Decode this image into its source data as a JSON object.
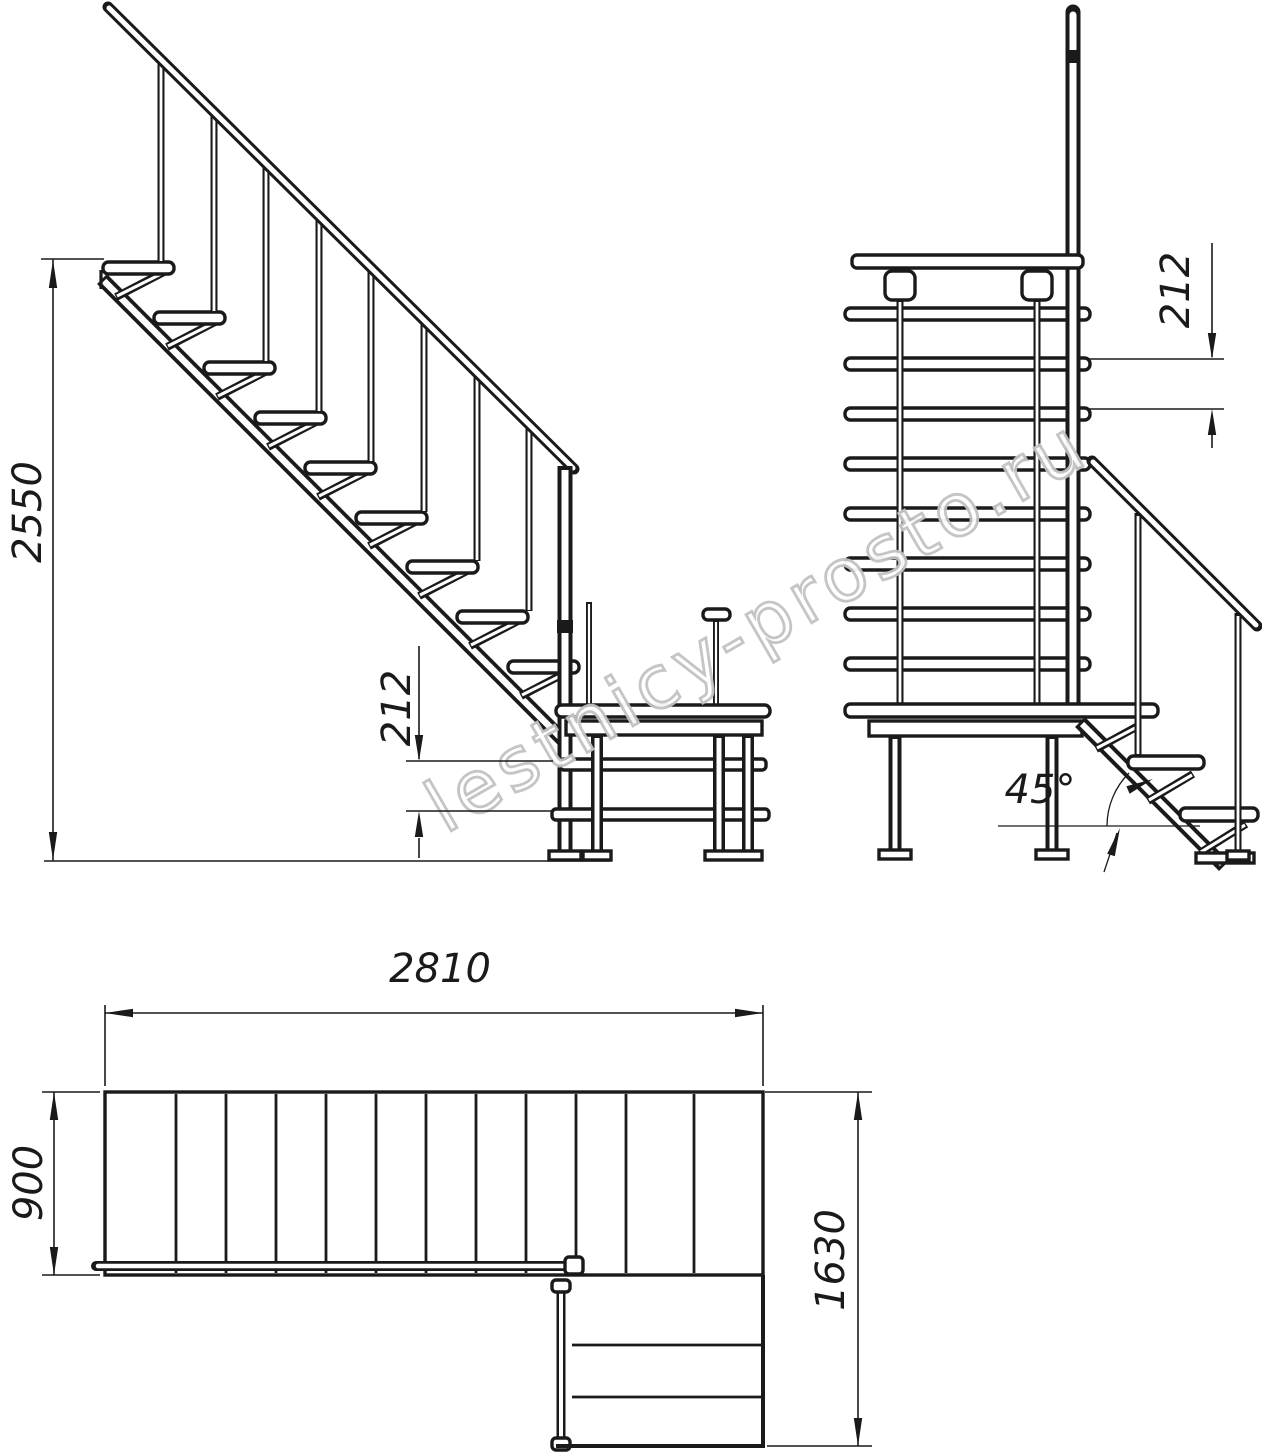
{
  "watermark": {
    "text": "lestnicy-prosto.ru",
    "color": "#c2c2c2"
  },
  "dims": {
    "side_total_height": "2550",
    "side_riser": "212",
    "front_riser": "212",
    "front_angle": "45°",
    "plan_length": "2810",
    "plan_flight_width": "900",
    "plan_total_depth": "1630"
  },
  "colors": {
    "line": "#1a1a1a",
    "background": "#ffffff"
  }
}
